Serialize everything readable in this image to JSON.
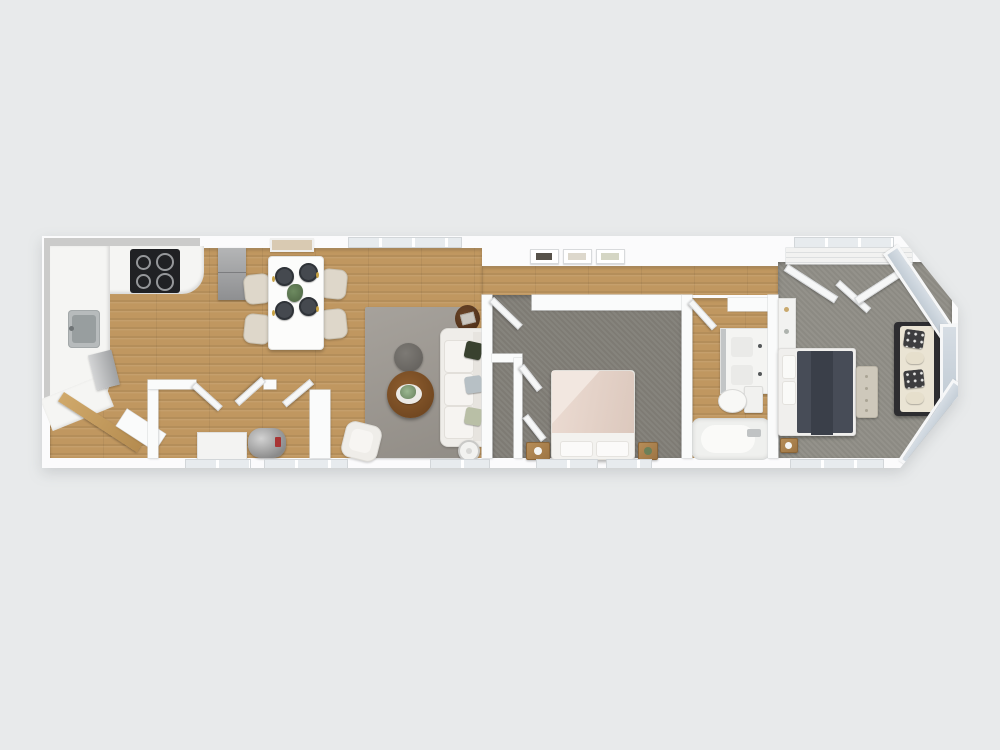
{
  "scene": {
    "type": "3D floor plan render, top-down view",
    "description": "Long narrow single-level home rendered in 3D from above on a plain light-gray background",
    "background_color": "#e8eaeb",
    "wall_color": "#fafbfb",
    "wood_floor_color": "#c09760",
    "carpet_color": "#8b8982"
  },
  "rooms": [
    {
      "name": "Kitchen",
      "floor": "wood",
      "items": [
        "L-shaped white counter",
        "black cooktop with 4 burners",
        "gray sink",
        "stainless dishwasher",
        "gray refrigerator",
        "upper cabinets"
      ]
    },
    {
      "name": "Dining area",
      "floor": "wood",
      "items": [
        "white rectangular table",
        "4 cream chairs",
        "4 dark place settings with gold cutlery",
        "green centerpiece",
        "beige wall art"
      ]
    },
    {
      "name": "Entry and utility hall",
      "floor": "wood",
      "items": [
        "wood entry door ajar",
        "closets with open doors",
        "gray water heater",
        "white appliance"
      ]
    },
    {
      "name": "Living room",
      "floor": "wood",
      "items": [
        "gray area rug",
        "white sofa with three pillows",
        "round wood coffee table with plant tray",
        "round gray side table",
        "dark wood accent table",
        "white armchair",
        "white floor lamp"
      ]
    },
    {
      "name": "Bedroom 2",
      "floor": "carpet",
      "items": [
        "bed with blush duvet and white pillows",
        "two wood nightstands with lamps",
        "closet with angled doors",
        "hinged entry door"
      ]
    },
    {
      "name": "Bathroom",
      "floor": "wood",
      "items": [
        "double-sink vanity",
        "toilet",
        "bathtub with faucet",
        "hinged door"
      ]
    },
    {
      "name": "Master bedroom",
      "floor": "carpet",
      "items": [
        "bed with charcoal duvet and white pillows",
        "tufted bench",
        "nightstand",
        "dresser",
        "wardrobe with angled doors",
        "cream loveseat with patterned pillows",
        "angled bay window"
      ]
    }
  ],
  "hallway": {
    "items": [
      "three small framed art prints on top wall",
      "wood floor strip"
    ]
  },
  "palette": {
    "duvet_blush": "#e3d0c6",
    "duvet_charcoal": "#474c57",
    "rug_gray": "#9a958e",
    "sofa_cream": "#efede9",
    "pillow_dark_green": "#39412f",
    "pillow_blue_gray": "#b7c0c5",
    "pillow_sage": "#b9bfa6",
    "coffee_table_wood": "#7a4c22",
    "bay_glass": "#ccd5dd",
    "cooktop_black": "#202124",
    "water_heater_gray": "#8e8e8e"
  }
}
